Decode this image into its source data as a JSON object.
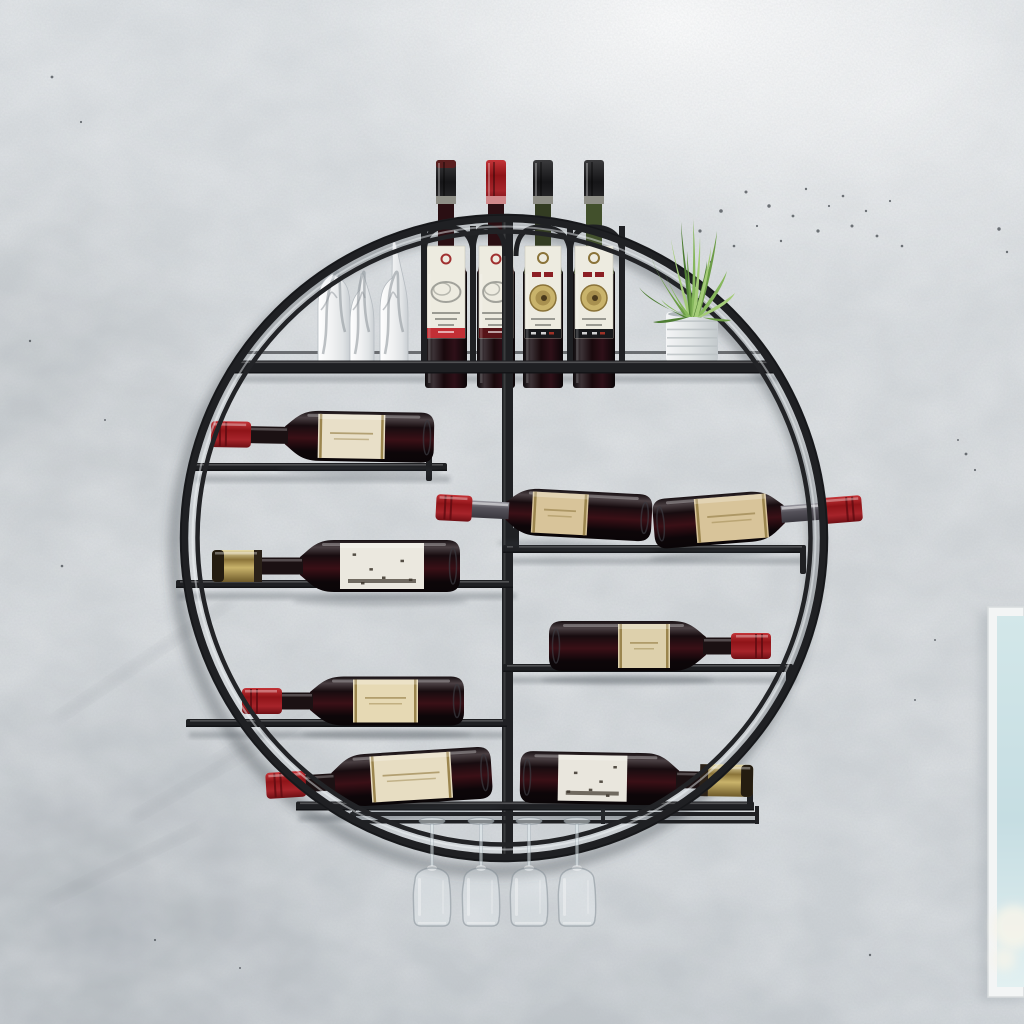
{
  "scene": {
    "label": "Round wall-mounted metal wine rack photo",
    "width": 1024,
    "height": 1024
  },
  "wall": {
    "base": "#d3d7da",
    "noise": "#787e84",
    "mottle": "#f4f6f7",
    "speckle": "#44494f",
    "speckles": [
      [
        700,
        231,
        1.6
      ],
      [
        711,
        262,
        1.2
      ],
      [
        721,
        211,
        1.8
      ],
      [
        734,
        246,
        1.3
      ],
      [
        746,
        192,
        1.5
      ],
      [
        757,
        226,
        1.1
      ],
      [
        769,
        206,
        1.7
      ],
      [
        781,
        241,
        1.2
      ],
      [
        793,
        216,
        1.4
      ],
      [
        806,
        189,
        1.2
      ],
      [
        818,
        231,
        1.6
      ],
      [
        829,
        206,
        1.1
      ],
      [
        843,
        196,
        1.3
      ],
      [
        852,
        226,
        1.5
      ],
      [
        866,
        211,
        1.2
      ],
      [
        877,
        236,
        1.4
      ],
      [
        890,
        201,
        1.1
      ],
      [
        902,
        246,
        1.3
      ],
      [
        999,
        229,
        1.7
      ],
      [
        1007,
        252,
        1.2
      ],
      [
        966,
        454,
        1.4
      ],
      [
        975,
        470,
        1.1
      ],
      [
        958,
        440,
        1.0
      ],
      [
        52,
        77,
        1.4
      ],
      [
        81,
        122,
        1.1
      ],
      [
        30,
        341,
        1.2
      ],
      [
        62,
        566,
        1.3
      ],
      [
        105,
        420,
        1.0
      ],
      [
        155,
        940,
        1.1
      ],
      [
        240,
        968,
        1.0
      ],
      [
        870,
        955,
        1.2
      ],
      [
        915,
        700,
        1.0
      ],
      [
        935,
        640,
        1.0
      ]
    ],
    "streaks": [
      [
        55,
        715,
        210,
        -34
      ],
      [
        130,
        815,
        260,
        -30
      ],
      [
        45,
        898,
        170,
        -26
      ],
      [
        210,
        760,
        150,
        -32
      ]
    ]
  },
  "frame": {
    "x": 988,
    "y": 607,
    "w": 36,
    "h": 390,
    "border": "#f3f5f5",
    "edge": "#d8dcdd",
    "inner_top": "#d3e7e9",
    "inner_mid": "#c6dde2",
    "inner_bottom": "#e2f0f1",
    "bloom": "#f6f4ea"
  },
  "rack": {
    "cx": 504,
    "cy": 538,
    "r_outer": 320,
    "r_highlight": 311.5,
    "r_inner": 306.5,
    "bar": "#1f2023",
    "bar_dark": "#131417",
    "bar_light": "#2e3034",
    "highlight": "rgba(245,248,250,0.45)",
    "divider": {
      "x": 502,
      "w": 11,
      "y1": 218,
      "y2": 855
    },
    "shadow": "rgba(62,68,76,0.38)"
  },
  "shelves": [
    {
      "name": "shelf-top",
      "x1": 232,
      "x2": 776,
      "y": 367,
      "h": 13,
      "back_rail": true
    },
    {
      "name": "shelf-left-1",
      "x1": 192,
      "x2": 447,
      "y": 467,
      "h": 8,
      "stops": [
        [
          426,
          427,
          481
        ]
      ]
    },
    {
      "name": "shelf-left-2",
      "x1": 176,
      "x2": 513,
      "y": 584,
      "h": 8,
      "stops": []
    },
    {
      "name": "shelf-left-3",
      "x1": 186,
      "x2": 507,
      "y": 723,
      "h": 8,
      "stops": []
    },
    {
      "name": "shelf-right-1",
      "x1": 503,
      "x2": 806,
      "y": 549,
      "h": 8,
      "stops": [
        [
          800,
          549,
          574
        ],
        [
          513,
          527,
          549
        ]
      ]
    },
    {
      "name": "shelf-right-2",
      "x1": 503,
      "x2": 793,
      "y": 668,
      "h": 8,
      "stops": [
        [
          786,
          668,
          686
        ]
      ]
    },
    {
      "name": "shelf-bottom",
      "x1": 296,
      "x2": 754,
      "y": 806,
      "h": 9,
      "stops": [
        [
          747,
          770,
          806
        ]
      ]
    }
  ],
  "glass_rails": {
    "x1": 350,
    "x2": 758,
    "y1": 812,
    "y2": 820,
    "h": 4,
    "pins": [
      352,
      601,
      755
    ]
  },
  "slot_bars": {
    "xs": [
      421,
      470,
      567,
      619
    ],
    "w": 6,
    "top": 226,
    "bottom": 372,
    "arches": [
      [
        421,
        470
      ],
      [
        470,
        502
      ],
      [
        513,
        567
      ],
      [
        567,
        619
      ]
    ],
    "arch_top": 227,
    "arch_base": 256
  },
  "standing_bottles": [
    {
      "x": 425,
      "w": 42,
      "cap": "blackred",
      "label": "sketch",
      "stripe": "#c22f35",
      "neck": "#2a0f13"
    },
    {
      "x": 477,
      "w": 38,
      "cap": "red",
      "label": "sketch",
      "stripe": "#571418",
      "neck": "#2a0f13"
    },
    {
      "x": 523,
      "w": 40,
      "cap": "black",
      "label": "medallion",
      "stripe": "#17181b",
      "neck": "#333c22"
    },
    {
      "x": 573,
      "w": 42,
      "cap": "black",
      "label": "medallion",
      "stripe": "#17181b",
      "neck": "#42502c"
    }
  ],
  "standing_geom": {
    "cap_top": 160,
    "cap_h": 44,
    "foil_y": 196,
    "neck_y": 204,
    "shoulder_y": 246,
    "body_y": 270,
    "base_y": 387,
    "label_y": 246,
    "label_h": 92
  },
  "deco_bottles": [
    {
      "x": 318,
      "w": 32,
      "top_y": 272,
      "spike": 0
    },
    {
      "x": 350,
      "w": 24,
      "top_y": 288,
      "spike": 14
    },
    {
      "x": 380,
      "w": 28,
      "top_y": 276,
      "spike": 34
    }
  ],
  "deco_base_y": 362,
  "lying_bottles": [
    {
      "name": "bottle-left-row-1",
      "tip_x": 211,
      "tip_y": 434,
      "dir": "left",
      "rot": 1,
      "cap": "red",
      "cap_l": 40,
      "neck_l": 34,
      "body_l": 149,
      "body_h": 50,
      "label_off": 33,
      "label_w": 67,
      "label": "band",
      "label_color": "#e8dfc8"
    },
    {
      "name": "bottle-left-row-2",
      "tip_x": 212,
      "tip_y": 566,
      "dir": "left",
      "rot": 0,
      "cap": "gold",
      "cap_l": 50,
      "neck_l": 38,
      "body_l": 160,
      "body_h": 52,
      "label_off": 40,
      "label_w": 84,
      "label": "worn",
      "label_color": "#ebe8df"
    },
    {
      "name": "bottle-left-row-3",
      "tip_x": 242,
      "tip_y": 701,
      "dir": "left",
      "rot": 0,
      "cap": "red",
      "cap_l": 40,
      "neck_l": 28,
      "body_l": 154,
      "body_h": 49,
      "label_off": 43,
      "label_w": 65,
      "label": "band",
      "label_color": "#e6d9b4"
    },
    {
      "name": "bottle-left-row-4",
      "tip_x": 266,
      "tip_y": 786,
      "dir": "left",
      "rot": -3.5,
      "cap": "red",
      "cap_l": 40,
      "neck_l": 26,
      "body_l": 160,
      "body_h": 52,
      "label_off": 39,
      "label_w": 81,
      "label": "band",
      "label_color": "#e7ddc2"
    },
    {
      "name": "bottle-right-row-1a",
      "tip_x": 436,
      "tip_y": 507,
      "dir": "left",
      "rot": 3,
      "cap": "red",
      "cap_l": 36,
      "neck_l": 34,
      "body_l": 146,
      "body_h": 47,
      "label_off": 26,
      "label_w": 56,
      "label": "band",
      "label_color": "#d8c49a",
      "silver_neck": true
    },
    {
      "name": "bottle-right-row-1b",
      "tip_x": 862,
      "tip_y": 508,
      "dir": "right",
      "rot": 4.5,
      "cap": "red",
      "cap_l": 42,
      "neck_l": 36,
      "body_l": 131,
      "body_h": 50,
      "label_off": 17,
      "label_w": 72,
      "label": "band",
      "label_color": "#d8c49a",
      "silver_neck": true
    },
    {
      "name": "bottle-right-row-2",
      "tip_x": 771,
      "tip_y": 646,
      "dir": "right",
      "rot": 0,
      "cap": "red",
      "cap_l": 40,
      "neck_l": 25,
      "body_l": 157,
      "body_h": 50,
      "label_off": 36,
      "label_w": 52,
      "label": "band",
      "label_color": "#ddd0ac"
    },
    {
      "name": "bottle-right-row-3",
      "tip_x": 753,
      "tip_y": 781,
      "dir": "right",
      "rot": -1,
      "cap": "gold",
      "cap_l": 53,
      "neck_l": 21,
      "body_l": 159,
      "body_h": 52,
      "label_off": 52,
      "label_w": 69,
      "label": "worn",
      "label_color": "#e9e6dd"
    }
  ],
  "colors": {
    "cap_red_1": "#c43438",
    "cap_red_2": "#8e1418",
    "cap_red_3": "#6e0f14",
    "cap_gold_1": "#e8dcab",
    "cap_gold_2": "#c9b36b",
    "cap_gold_3": "#6e5a2a",
    "cap_black_1": "#3a3a3c",
    "cap_black_2": "#151517",
    "glass_dark": "#0a0507",
    "glass_mid": "#3a1016",
    "glass_sheen": "#4a4043",
    "silver": "#6d6c74",
    "label_line": "#9b854e",
    "label_ink": "#3a332a",
    "seal_red": "#a03030",
    "coin_gold": "#c9b36b",
    "coin_rim": "#8a7339",
    "text_gray": "#9a9a92"
  },
  "plant": {
    "pot_x": 666,
    "pot_y": 312,
    "pot_w": 52,
    "pot_h": 50,
    "pot_light": "#f4f5f6",
    "pot_dark": "#c2c8cb",
    "rib": "#b9bfc2",
    "greens": [
      "#4e7d33",
      "#6c9c46",
      "#86b75c",
      "#a5cc79"
    ],
    "base_x": 691,
    "base_y": 317,
    "leaves": [
      [
        -52,
        -30,
        -18
      ],
      [
        -40,
        -62,
        -14
      ],
      [
        -30,
        -18,
        -10
      ],
      [
        -20,
        -78,
        -6
      ],
      [
        -10,
        -95,
        -4
      ],
      [
        -4,
        -66,
        -2
      ],
      [
        2,
        -98,
        2
      ],
      [
        9,
        -80,
        3
      ],
      [
        16,
        -56,
        5
      ],
      [
        26,
        -86,
        8
      ],
      [
        36,
        -46,
        10
      ],
      [
        44,
        -24,
        12
      ],
      [
        -38,
        5,
        -9
      ],
      [
        40,
        3,
        10
      ],
      [
        -26,
        -44,
        -8
      ],
      [
        20,
        -70,
        6
      ]
    ]
  },
  "glasses": {
    "centers": [
      432,
      481,
      529,
      577
    ],
    "foot_y": 821,
    "stem_top": 824,
    "stem_bottom": 866,
    "bowl_top": 870,
    "bowl_bottom": 926,
    "half_w": 20,
    "tint": "rgba(238,244,247,0.30)",
    "edge": "rgba(125,135,143,0.50)",
    "shine": "rgba(255,255,255,0.55)"
  },
  "deco_vein": "#8b9197"
}
